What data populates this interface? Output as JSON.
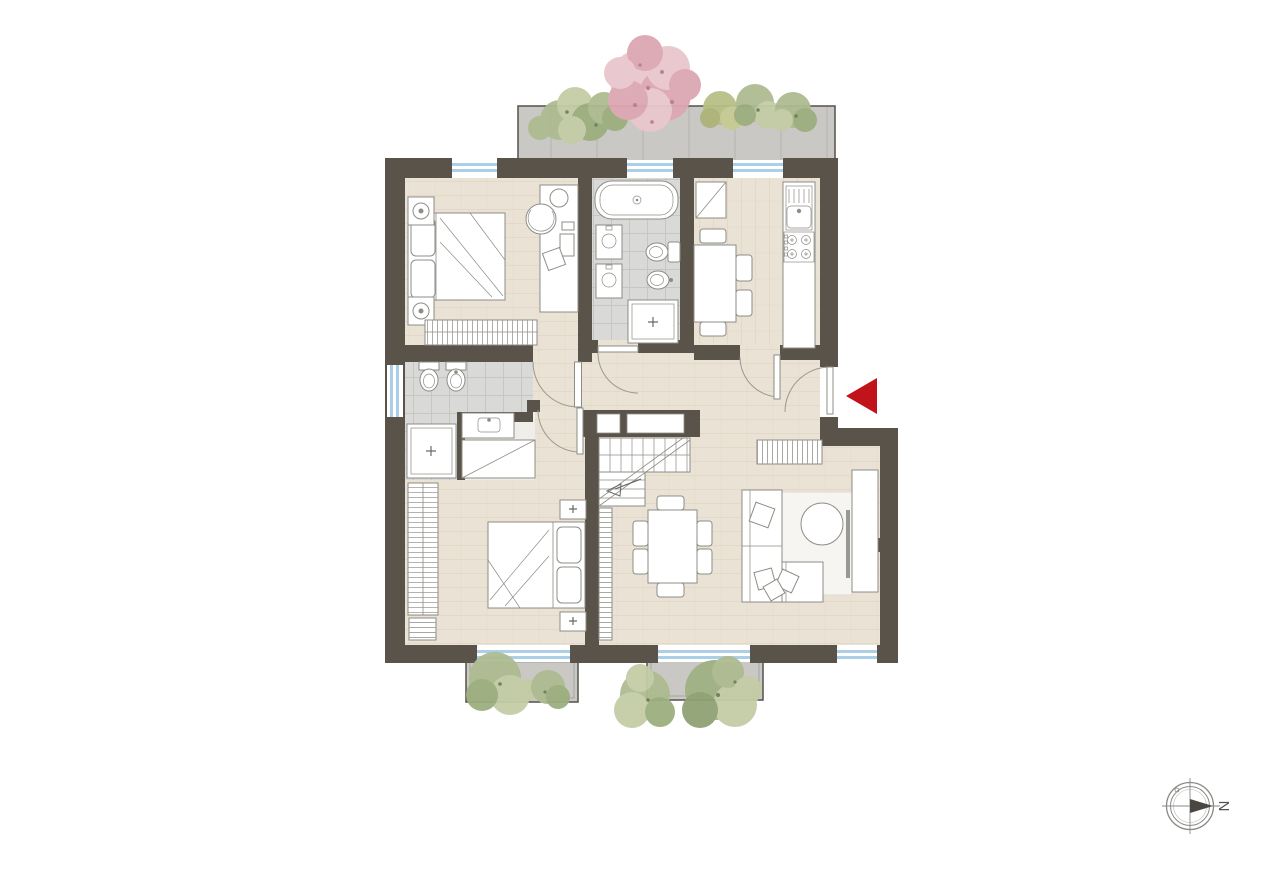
{
  "canvas": {
    "width": 1280,
    "height": 893,
    "background": "#ffffff"
  },
  "compass": {
    "label": "N"
  },
  "icons": {
    "entrance_marker": "red-triangle-left-icon",
    "compass": "compass-rose-icon"
  },
  "palette": {
    "wall": "#59534a",
    "wall_dark": "#4c463e",
    "floor_wood": "#eae2d4",
    "floor_wood_grain": "#ddd2c0",
    "tile_bath": "#d9d9d7",
    "tile_joint": "#c6c6c3",
    "terrace": "#c9c8c4",
    "terrace_joint": "#b9b8b4",
    "window_blue": "#aacfe6",
    "fixture_stroke": "#8e8c86",
    "fixture_fill": "#ffffff",
    "accent_red": "#c0141a",
    "door_arc": "#9a988f",
    "rug": "#f7f5f1",
    "plant_green_1": "#aebb90",
    "plant_green_2": "#9cae7f",
    "plant_green_3": "#c3cda6",
    "plant_olive": "#b9bf85",
    "plant_pink_1": "#e9c6cd",
    "plant_pink_2": "#dca7b3",
    "plant_pink_dark": "#b77e90",
    "compass_stroke": "#8a8a85",
    "compass_dark": "#4a4742"
  }
}
